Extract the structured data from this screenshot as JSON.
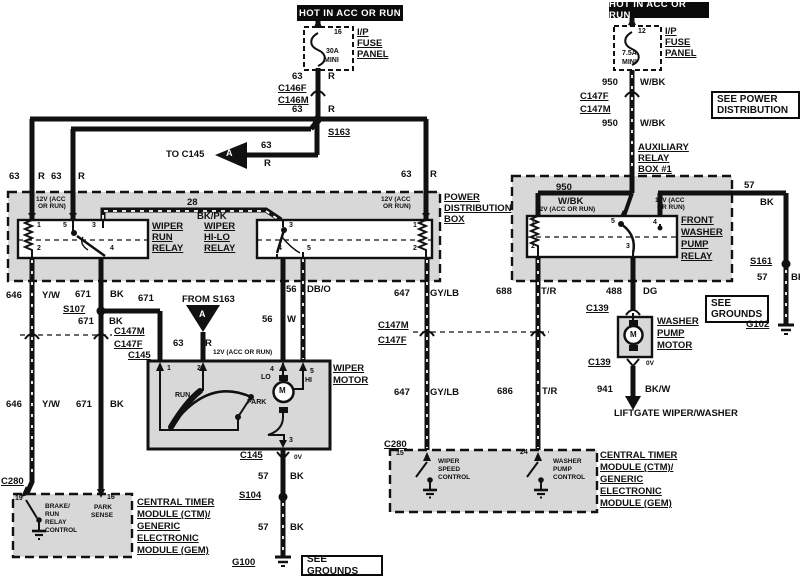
{
  "title": "Wiper / Washer wiring diagram",
  "colors": {
    "wire": "#111111",
    "box_fill": "#d8d8d8",
    "background": "#ffffff"
  },
  "headers": {
    "left": "HOT IN ACC OR RUN",
    "right": "HOT IN ACC OR RUN"
  },
  "callouts": {
    "see_power_1": "SEE POWER",
    "see_power_2": "DISTRIBUTION",
    "see_grounds": "SEE GROUNDS",
    "see_grounds_r1": "SEE",
    "see_grounds_r2": "GROUNDS"
  },
  "labels": [
    [
      "fuse-left-position",
      "16",
      334,
      29,
      "sm"
    ],
    [
      "fuse-left-rating",
      "30A",
      326,
      48,
      "sm"
    ],
    [
      "fuse-left-mini",
      "MINI",
      324,
      57,
      "sm"
    ],
    [
      "ip-fuse-panel-left-1",
      "I/P",
      357,
      28,
      "u"
    ],
    [
      "ip-fuse-panel-left-2",
      "FUSE",
      357,
      39,
      "u"
    ],
    [
      "ip-fuse-panel-left-3",
      "PANEL",
      357,
      50,
      "u"
    ],
    [
      "wire-63-1",
      "63",
      292,
      72,
      ""
    ],
    [
      "wire-63-1c",
      "R",
      328,
      72,
      ""
    ],
    [
      "conn-c146f",
      "C146F",
      278,
      84,
      "u"
    ],
    [
      "conn-c146m",
      "C146M",
      278,
      96,
      "u"
    ],
    [
      "wire-63-2",
      "63",
      292,
      105,
      ""
    ],
    [
      "wire-63-2c",
      "R",
      328,
      105,
      ""
    ],
    [
      "splice-s163",
      "S163",
      328,
      128,
      "u"
    ],
    [
      "to-c145",
      "TO C145",
      166,
      150,
      ""
    ],
    [
      "wire-63-3",
      "63",
      261,
      141,
      ""
    ],
    [
      "wire-63-3c",
      "R",
      264,
      159,
      ""
    ],
    [
      "triangle-a-left",
      "A",
      226,
      149,
      "w"
    ],
    [
      "wire-63-4",
      "63",
      401,
      170,
      ""
    ],
    [
      "wire-63-4c",
      "R",
      430,
      170,
      ""
    ],
    [
      "wire-63-5",
      "63",
      9,
      172,
      ""
    ],
    [
      "wire-63-5c",
      "R",
      38,
      172,
      ""
    ],
    [
      "wire-63-6",
      "63",
      51,
      172,
      ""
    ],
    [
      "wire-63-6c",
      "R",
      78,
      172,
      ""
    ],
    [
      "pdb-12v-1a",
      "12V (ACC",
      36,
      197,
      "xs"
    ],
    [
      "pdb-12v-1b",
      "OR RUN)",
      38,
      204,
      "xs"
    ],
    [
      "wire-28",
      "28",
      187,
      198,
      ""
    ],
    [
      "wire-28c",
      "BK/PK",
      197,
      212,
      ""
    ],
    [
      "pdb-12v-2a",
      "12V (ACC",
      381,
      197,
      "xs"
    ],
    [
      "pdb-12v-2b",
      "OR RUN)",
      383,
      204,
      "xs"
    ],
    [
      "pdb-label-1",
      "POWER",
      444,
      193,
      "u"
    ],
    [
      "pdb-label-2",
      "DISTRIBUTION",
      444,
      204,
      "u"
    ],
    [
      "pdb-label-3",
      "BOX",
      444,
      215,
      "u"
    ],
    [
      "run-relay-pin1",
      "1",
      37,
      222,
      "sm"
    ],
    [
      "run-relay-pin5",
      "5",
      63,
      222,
      "sm"
    ],
    [
      "run-relay-pin3",
      "3",
      92,
      222,
      "sm"
    ],
    [
      "run-relay-pin2",
      "2",
      37,
      245,
      "sm"
    ],
    [
      "run-relay-pin4",
      "4",
      110,
      245,
      "sm"
    ],
    [
      "wiper-run-relay-1",
      "WIPER",
      152,
      222,
      "u"
    ],
    [
      "wiper-run-relay-2",
      "RUN",
      152,
      233,
      "u"
    ],
    [
      "wiper-run-relay-3",
      "RELAY",
      152,
      244,
      "u"
    ],
    [
      "wiper-hilo-relay-1",
      "WIPER",
      204,
      222,
      "u"
    ],
    [
      "wiper-hilo-relay-2",
      "HI-LO",
      204,
      233,
      "u"
    ],
    [
      "wiper-hilo-relay-3",
      "RELAY",
      204,
      244,
      "u"
    ],
    [
      "hilo-pin3",
      "3",
      289,
      222,
      "sm"
    ],
    [
      "hilo-pin1",
      "1",
      413,
      222,
      "sm"
    ],
    [
      "hilo-pin4",
      "4",
      278,
      245,
      "sm"
    ],
    [
      "hilo-pin5",
      "5",
      307,
      245,
      "sm"
    ],
    [
      "hilo-pin2",
      "2",
      413,
      245,
      "sm"
    ],
    [
      "wire-646-1",
      "646",
      6,
      291,
      ""
    ],
    [
      "wire-646-1c",
      "Y/W",
      42,
      291,
      ""
    ],
    [
      "wire-671-1",
      "671",
      75,
      290,
      ""
    ],
    [
      "wire-671-1c",
      "BK",
      110,
      290,
      ""
    ],
    [
      "wire-671-2",
      "671",
      138,
      294,
      ""
    ],
    [
      "splice-s107",
      "S107",
      63,
      305,
      "u"
    ],
    [
      "wire-671-3",
      "671",
      78,
      317,
      ""
    ],
    [
      "wire-671-3c",
      "BK",
      109,
      317,
      ""
    ],
    [
      "conn-c147m-left",
      "C147M",
      114,
      327,
      "u"
    ],
    [
      "conn-c147f-left",
      "C147F",
      114,
      340,
      "u"
    ],
    [
      "conn-c145-branch",
      "C145",
      128,
      351,
      "u"
    ],
    [
      "from-s163",
      "FROM S163",
      182,
      295,
      ""
    ],
    [
      "triangle-a-down",
      "A",
      199,
      310,
      "w"
    ],
    [
      "wire-63-7",
      "63",
      173,
      339,
      ""
    ],
    [
      "wire-63-7c",
      "R",
      205,
      339,
      ""
    ],
    [
      "wm-12v",
      "12V (ACC OR RUN)",
      213,
      350,
      "xs"
    ],
    [
      "wire-646-2",
      "646",
      6,
      400,
      ""
    ],
    [
      "wire-646-2c",
      "Y/W",
      42,
      400,
      ""
    ],
    [
      "wire-671-4",
      "671",
      76,
      400,
      ""
    ],
    [
      "wire-671-4c",
      "BK",
      110,
      400,
      ""
    ],
    [
      "wire-56-1",
      "56",
      286,
      285,
      ""
    ],
    [
      "wire-56-1c",
      "DB/O",
      307,
      285,
      ""
    ],
    [
      "wire-56-2",
      "56",
      262,
      315,
      ""
    ],
    [
      "wire-56-2c",
      "W",
      287,
      315,
      ""
    ],
    [
      "wire-647-1",
      "647",
      394,
      289,
      ""
    ],
    [
      "wire-647-1c",
      "GY/LB",
      430,
      289,
      ""
    ],
    [
      "conn-c147m-mid",
      "C147M",
      378,
      321,
      "u"
    ],
    [
      "conn-c147f-mid",
      "C147F",
      378,
      336,
      "u"
    ],
    [
      "wire-647-2",
      "647",
      394,
      388,
      ""
    ],
    [
      "wire-647-2c",
      "GY/LB",
      430,
      388,
      ""
    ],
    [
      "wire-688",
      "688",
      496,
      287,
      ""
    ],
    [
      "wire-688c",
      "T/R",
      541,
      287,
      ""
    ],
    [
      "wire-686",
      "686",
      497,
      387,
      ""
    ],
    [
      "wire-686c",
      "T/R",
      542,
      387,
      ""
    ],
    [
      "wiper-motor-label-1",
      "WIPER",
      333,
      364,
      "u"
    ],
    [
      "wiper-motor-label-2",
      "MOTOR",
      333,
      376,
      "u"
    ],
    [
      "wm-pin1",
      "1",
      167,
      365,
      "sm"
    ],
    [
      "wm-pin2",
      "2",
      197,
      365,
      "sm"
    ],
    [
      "wm-pin4",
      "4",
      270,
      366,
      "sm"
    ],
    [
      "wm-pin5",
      "5",
      310,
      368,
      "sm"
    ],
    [
      "wm-pin3",
      "3",
      289,
      437,
      "sm"
    ],
    [
      "wm-lo",
      "LO",
      261,
      374,
      "sm"
    ],
    [
      "wm-hi",
      "HI",
      305,
      377,
      "sm"
    ],
    [
      "wm-run",
      "RUN",
      175,
      392,
      "sm"
    ],
    [
      "wm-park",
      "PARK",
      247,
      399,
      "sm"
    ],
    [
      "wiper-motor-m",
      "M",
      279,
      387,
      "m"
    ],
    [
      "conn-c145-bottom",
      "C145",
      240,
      451,
      "u"
    ],
    [
      "c145-0v",
      "0V",
      294,
      455,
      "xs"
    ],
    [
      "wire-57-1",
      "57",
      258,
      472,
      ""
    ],
    [
      "wire-57-1c",
      "BK",
      290,
      472,
      ""
    ],
    [
      "splice-s104",
      "S104",
      239,
      491,
      "u"
    ],
    [
      "wire-57-2",
      "57",
      258,
      523,
      ""
    ],
    [
      "wire-57-2c",
      "BK",
      290,
      523,
      ""
    ],
    [
      "ground-g100",
      "G100",
      232,
      558,
      "u"
    ],
    [
      "conn-c280-left",
      "C280",
      1,
      477,
      "u"
    ],
    [
      "lm-pin19",
      "19",
      15,
      495,
      "sm"
    ],
    [
      "lm-pin16",
      "16",
      107,
      494,
      "sm"
    ],
    [
      "lm-brake-1",
      "BRAKE/",
      45,
      504,
      "xs"
    ],
    [
      "lm-brake-2",
      "RUN",
      45,
      512,
      "xs"
    ],
    [
      "lm-brake-3",
      "RELAY",
      45,
      520,
      "xs"
    ],
    [
      "lm-brake-4",
      "CONTROL",
      45,
      528,
      "xs"
    ],
    [
      "lm-park-1",
      "PARK",
      94,
      505,
      "xs"
    ],
    [
      "lm-park-2",
      "SENSE",
      91,
      513,
      "xs"
    ],
    [
      "ctm-left-1",
      "CENTRAL TIMER",
      137,
      498,
      "u"
    ],
    [
      "ctm-left-2",
      "MODULE (CTM)/",
      137,
      510,
      "u"
    ],
    [
      "ctm-left-3",
      "GENERIC",
      137,
      522,
      "u"
    ],
    [
      "ctm-left-4",
      "ELECTRONIC",
      137,
      534,
      "u"
    ],
    [
      "ctm-left-5",
      "MODULE (GEM)",
      137,
      546,
      "u"
    ],
    [
      "fuse-right-position",
      "12",
      638,
      28,
      "sm"
    ],
    [
      "fuse-right-rating",
      "7.5A",
      622,
      50,
      "sm"
    ],
    [
      "fuse-right-mini",
      "MINI",
      622,
      59,
      "sm"
    ],
    [
      "ip-fuse-panel-right-1",
      "I/P",
      665,
      27,
      "u"
    ],
    [
      "ip-fuse-panel-right-2",
      "FUSE",
      665,
      38,
      "u"
    ],
    [
      "ip-fuse-panel-right-3",
      "PANEL",
      665,
      49,
      "u"
    ],
    [
      "wire-950-1",
      "950",
      602,
      78,
      ""
    ],
    [
      "wire-950-1c",
      "W/BK",
      640,
      78,
      ""
    ],
    [
      "conn-c147f-right",
      "C147F",
      580,
      92,
      "u"
    ],
    [
      "conn-c147m-right",
      "C147M",
      580,
      105,
      "u"
    ],
    [
      "wire-950-2",
      "950",
      602,
      119,
      ""
    ],
    [
      "wire-950-2c",
      "W/BK",
      640,
      119,
      ""
    ],
    [
      "aux-box-label-1",
      "AUXILIARY",
      638,
      143,
      "u"
    ],
    [
      "aux-box-label-2",
      "RELAY",
      638,
      154,
      "u"
    ],
    [
      "aux-box-label-3",
      "BOX #1",
      638,
      165,
      "u"
    ],
    [
      "wire-950-3",
      "950",
      556,
      183,
      ""
    ],
    [
      "wire-950-3c",
      "W/BK",
      558,
      197,
      ""
    ],
    [
      "aux-12v-1",
      "12V (ACC OR RUN)",
      536,
      207,
      "xs"
    ],
    [
      "aux-12v-2a",
      "12V (ACC",
      655,
      198,
      "xs"
    ],
    [
      "aux-12v-2b",
      "OR RUN)",
      657,
      205,
      "xs"
    ],
    [
      "wire-57-3",
      "57",
      744,
      181,
      ""
    ],
    [
      "wire-57-3c",
      "BK",
      760,
      198,
      ""
    ],
    [
      "aux-relay-pin1",
      "1",
      531,
      219,
      "sm"
    ],
    [
      "aux-relay-pin5",
      "5",
      611,
      218,
      "sm"
    ],
    [
      "aux-relay-pin4",
      "4",
      653,
      219,
      "sm"
    ],
    [
      "aux-relay-pin2",
      "2",
      531,
      243,
      "sm"
    ],
    [
      "aux-relay-pin3",
      "3",
      626,
      243,
      "sm"
    ],
    [
      "front-washer-relay-1",
      "FRONT",
      681,
      216,
      "u"
    ],
    [
      "front-washer-relay-2",
      "WASHER",
      681,
      228,
      "u"
    ],
    [
      "front-washer-relay-3",
      "PUMP",
      681,
      240,
      "u"
    ],
    [
      "front-washer-relay-4",
      "RELAY",
      681,
      252,
      "u"
    ],
    [
      "splice-s161",
      "S161",
      750,
      257,
      "u"
    ],
    [
      "wire-57-4",
      "57",
      757,
      273,
      ""
    ],
    [
      "wire-57-4c",
      "BK",
      791,
      273,
      ""
    ],
    [
      "ground-g102",
      "G102",
      746,
      320,
      "u"
    ],
    [
      "wire-488",
      "488",
      606,
      287,
      ""
    ],
    [
      "wire-488c",
      "DG",
      643,
      287,
      ""
    ],
    [
      "conn-c139-top",
      "C139",
      586,
      304,
      "u"
    ],
    [
      "washer-pump-motor-1",
      "WASHER",
      657,
      317,
      "u"
    ],
    [
      "washer-pump-motor-2",
      "PUMP",
      657,
      329,
      "u"
    ],
    [
      "washer-pump-motor-3",
      "MOTOR",
      657,
      341,
      "u"
    ],
    [
      "washer-motor-m",
      "M",
      630,
      331,
      "m"
    ],
    [
      "conn-c139-bottom",
      "C139",
      588,
      358,
      "u"
    ],
    [
      "c139-0v",
      "0V",
      646,
      361,
      "xs"
    ],
    [
      "wire-941",
      "941",
      597,
      385,
      ""
    ],
    [
      "wire-941c",
      "BK/W",
      645,
      385,
      ""
    ],
    [
      "liftgate-note",
      "LIFTGATE WIPER/WASHER",
      614,
      409,
      ""
    ],
    [
      "conn-c280-right",
      "C280",
      384,
      440,
      "u"
    ],
    [
      "rm-pin15",
      "15",
      396,
      450,
      "sm"
    ],
    [
      "rm-pin24",
      "24",
      520,
      449,
      "sm"
    ],
    [
      "rm-wsc-1",
      "WIPER",
      438,
      459,
      "xs"
    ],
    [
      "rm-wsc-2",
      "SPEED",
      438,
      467,
      "xs"
    ],
    [
      "rm-wsc-3",
      "CONTROL",
      438,
      475,
      "xs"
    ],
    [
      "rm-wpc-1",
      "WASHER",
      553,
      459,
      "xs"
    ],
    [
      "rm-wpc-2",
      "PUMP",
      553,
      467,
      "xs"
    ],
    [
      "rm-wpc-3",
      "CONTROL",
      553,
      475,
      "xs"
    ],
    [
      "ctm-right-1",
      "CENTRAL TIMER",
      600,
      451,
      "u"
    ],
    [
      "ctm-right-2",
      "MODULE (CTM)/",
      600,
      463,
      "u"
    ],
    [
      "ctm-right-3",
      "GENERIC",
      600,
      475,
      "u"
    ],
    [
      "ctm-right-4",
      "ELECTRONIC",
      600,
      487,
      "u"
    ],
    [
      "ctm-right-5",
      "MODULE (GEM)",
      600,
      499,
      "u"
    ]
  ]
}
